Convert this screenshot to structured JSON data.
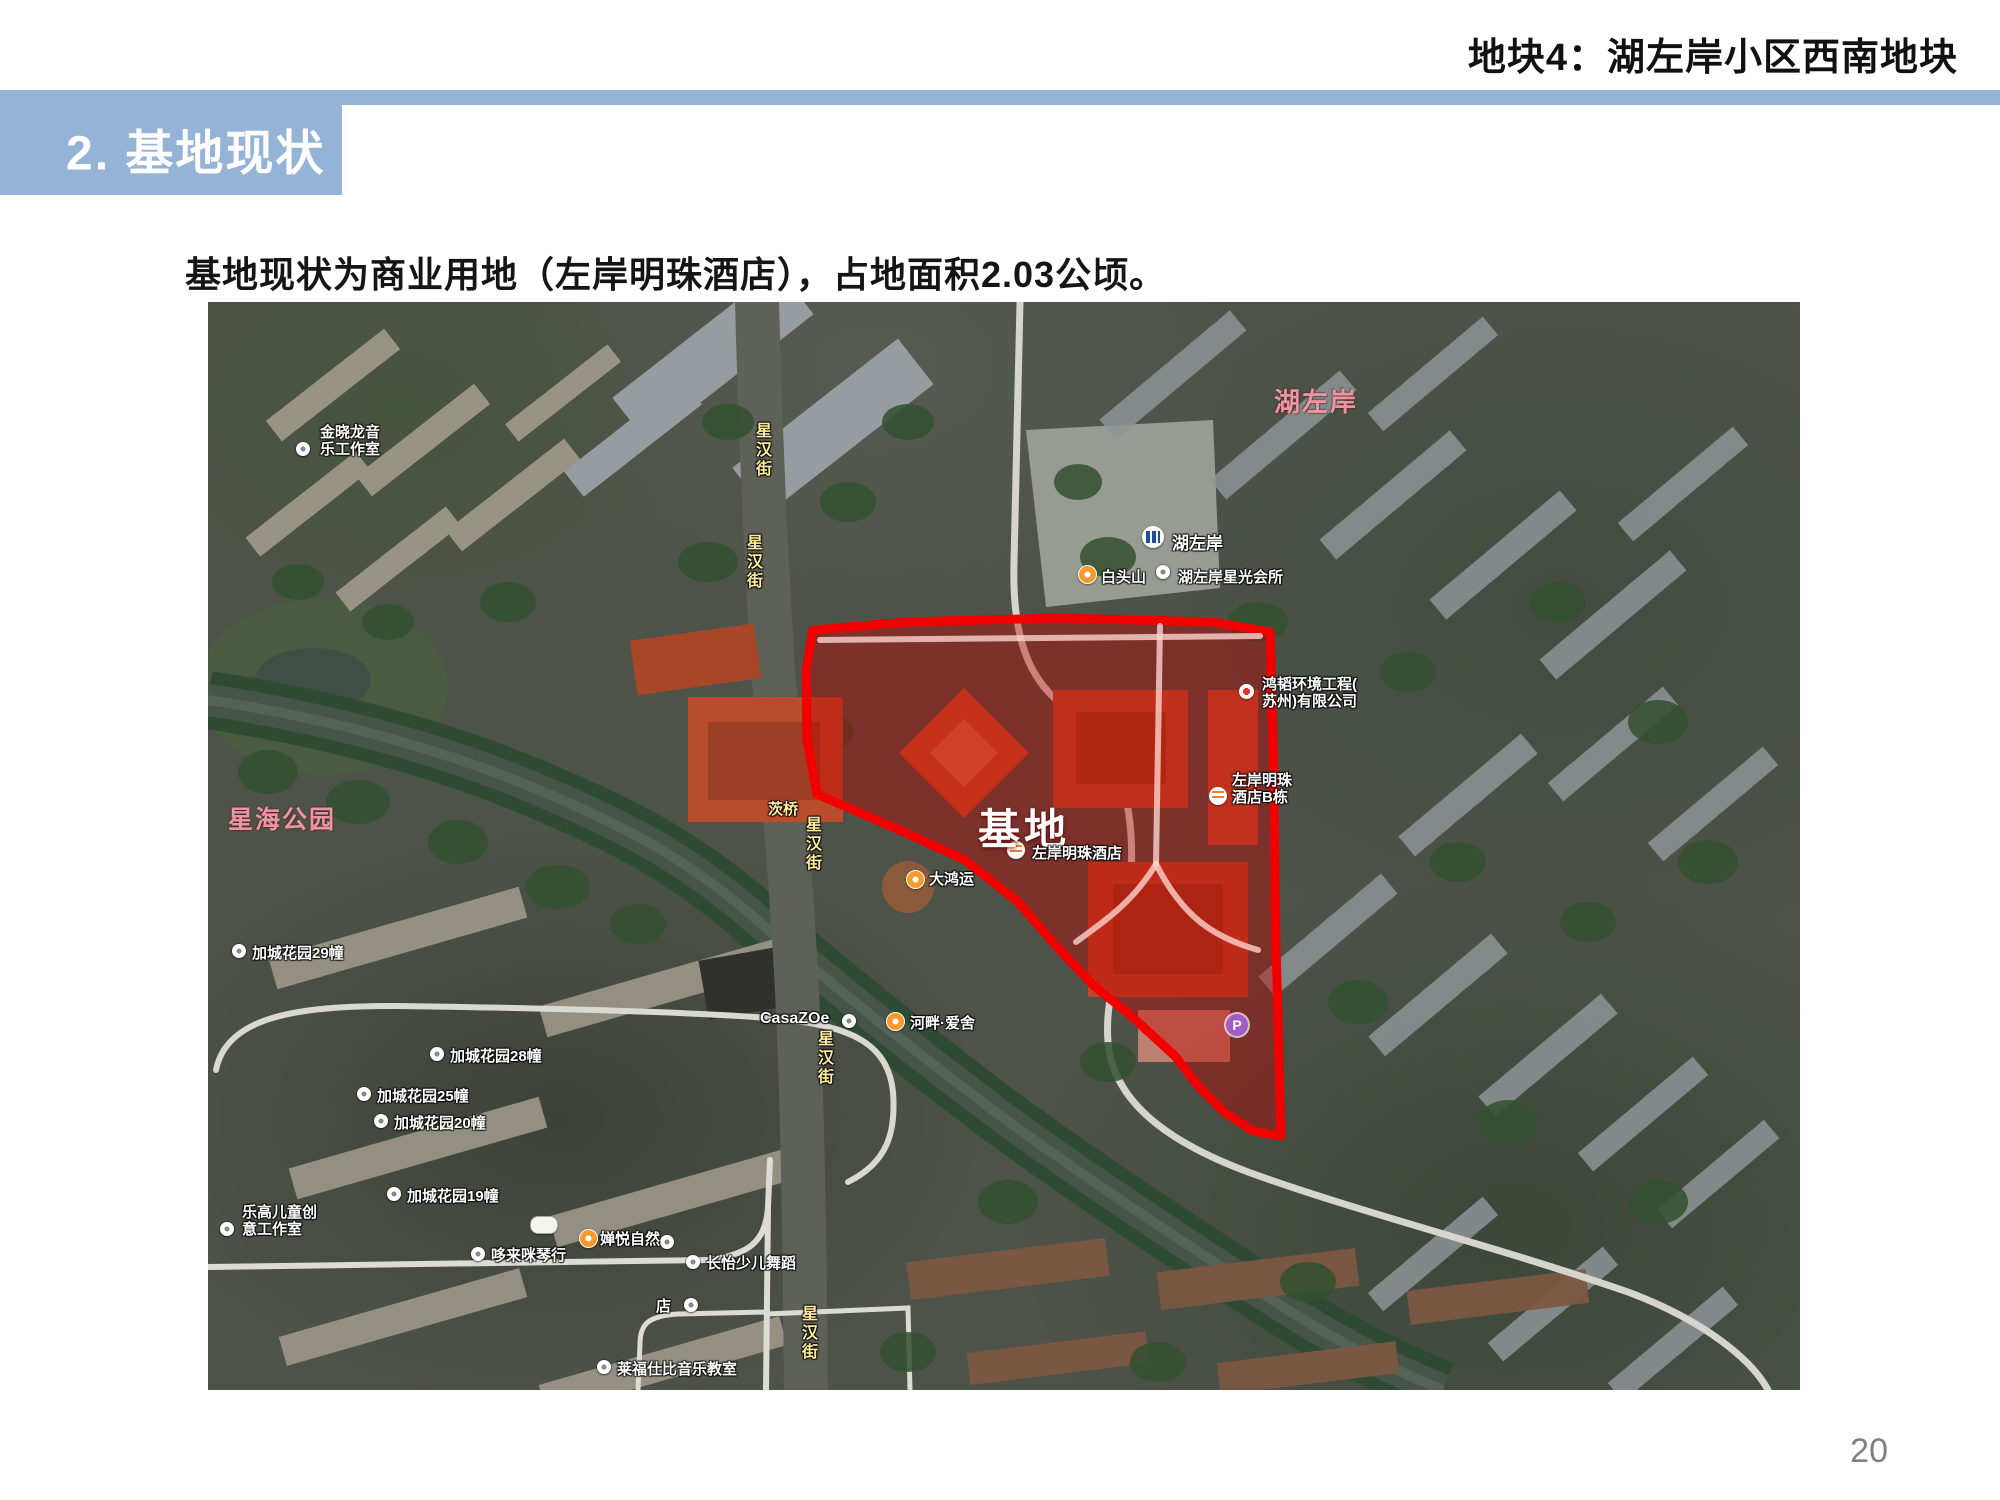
{
  "page": {
    "kicker": "地块4：湖左岸小区西南地块",
    "section_title": "2. 基地现状",
    "body_text": "基地现状为商业用地（左岸明珠酒店），占地面积2.03公顷。",
    "page_number": "20"
  },
  "colors": {
    "accent": "#95B3D7",
    "site_outline": "#F20000",
    "site_fill": "rgba(195,0,0,0.40)",
    "road_label": "#FFEC9E",
    "district_label": "#EF93A0"
  },
  "map": {
    "site_label": "基地",
    "district": "湖左岸",
    "park": "星海公园",
    "bridge": "茨桥",
    "road": "星汉街",
    "metro": "湖左岸",
    "pois": {
      "baitou": "白头山",
      "club": "湖左岸星光会所",
      "studio1": "金晓龙音",
      "studio2": "乐工作室",
      "hotel": "左岸明珠酒店",
      "hotelb1": "左岸明珠",
      "hotelb2": "酒店B栋",
      "dahongyun": "大鸿运",
      "company1": "鸿韬环境工程(",
      "company2": "苏州)有限公司",
      "jc29": "加城花园29幢",
      "jc28": "加城花园28幢",
      "jc25": "加城花园25幢",
      "jc20": "加城花园20幢",
      "jc19": "加城花园19幢",
      "lego1": "乐高儿童创",
      "lego2": "意工作室",
      "piano": "哆来咪琴行",
      "chanyue": "婵悦自然",
      "dance": "长怡少儿舞蹈",
      "shop": "店",
      "casazoe": "CasaZOe",
      "riverside": "河畔·爱舍",
      "musicschool": "莱福仕比音乐教室",
      "parking": "P"
    }
  }
}
